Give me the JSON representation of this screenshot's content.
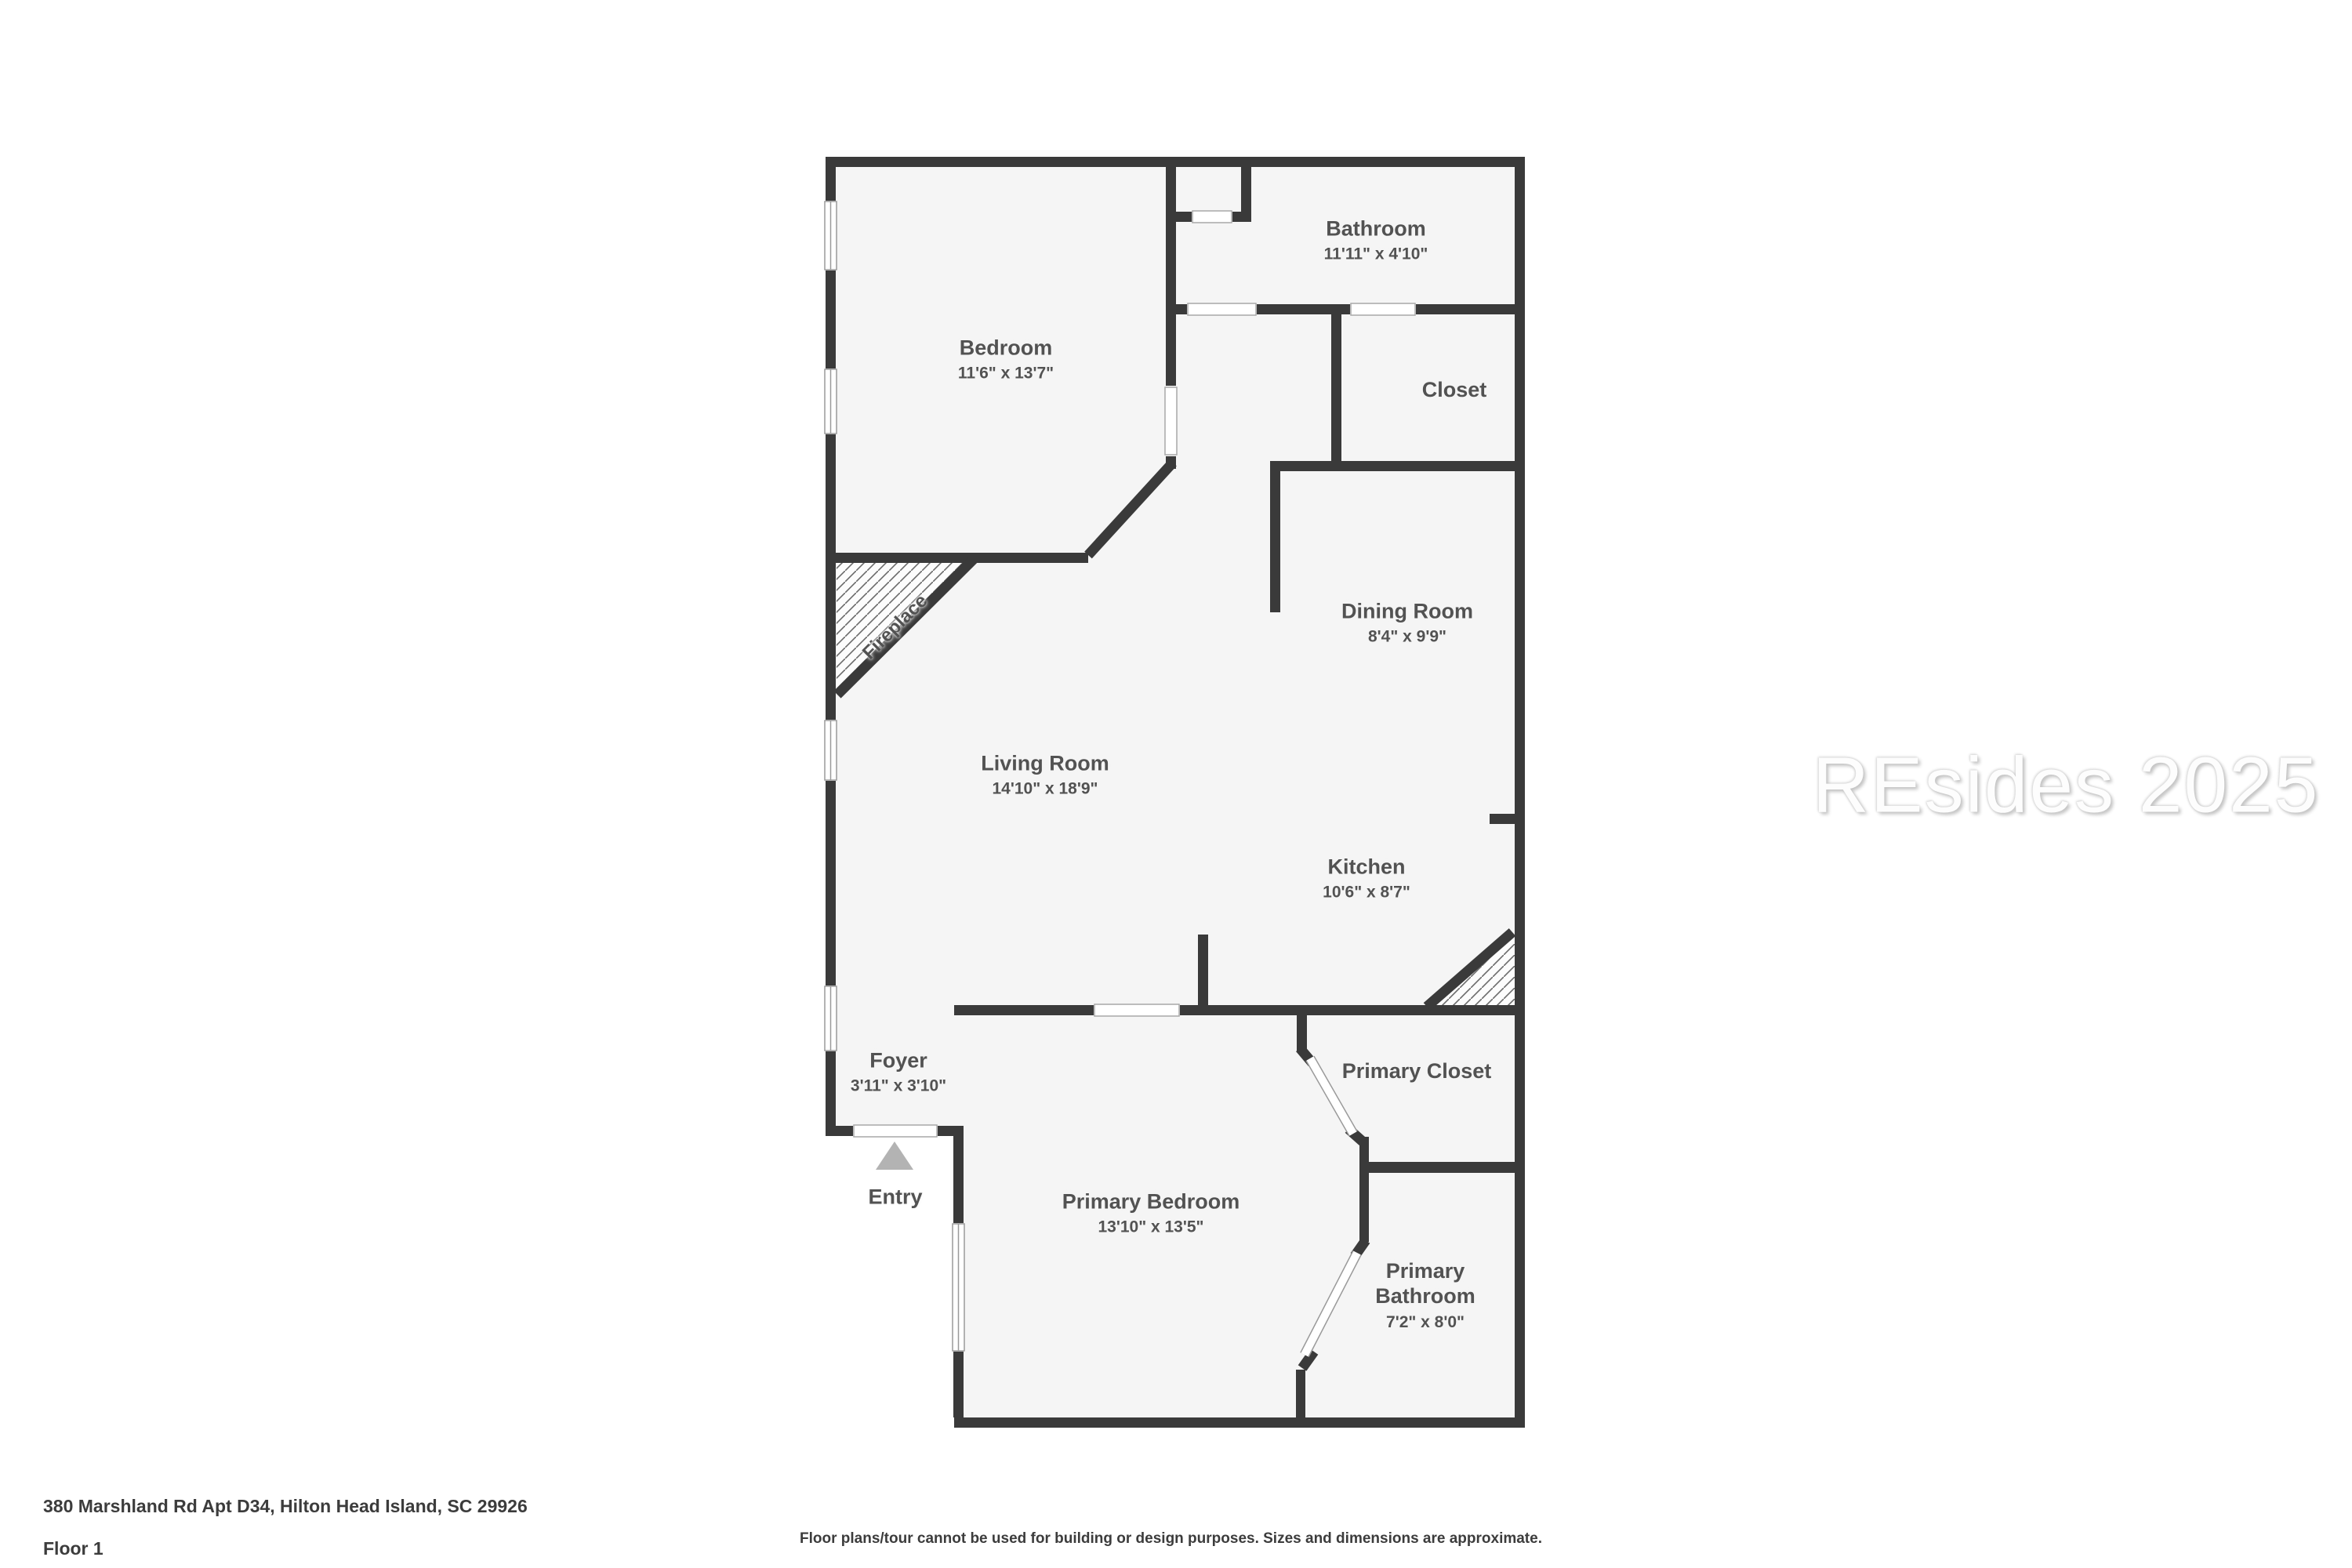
{
  "plan": {
    "rooms": {
      "bathroom": {
        "name": "Bathroom",
        "dims": "11'11\" x 4'10\""
      },
      "bedroom": {
        "name": "Bedroom",
        "dims": "11'6\" x 13'7\""
      },
      "closet": {
        "name": "Closet",
        "dims": ""
      },
      "dining_room": {
        "name": "Dining Room",
        "dims": "8'4\" x 9'9\""
      },
      "living_room": {
        "name": "Living Room",
        "dims": "14'10\" x 18'9\""
      },
      "kitchen": {
        "name": "Kitchen",
        "dims": "10'6\" x 8'7\""
      },
      "foyer": {
        "name": "Foyer",
        "dims": "3'11\" x 3'10\""
      },
      "primary_closet": {
        "name": "Primary Closet",
        "dims": ""
      },
      "primary_bedroom": {
        "name": "Primary Bedroom",
        "dims": "13'10\" x 13'5\""
      },
      "primary_bathroom": {
        "name": "Primary Bathroom",
        "dims": "7'2\" x 8'0\""
      }
    },
    "annotations": {
      "fireplace": "Fireplace",
      "entry": "Entry"
    },
    "icons": {
      "entry_arrow": "entry-arrow-icon"
    },
    "colors": {
      "wall": "#3a3a3a",
      "floor": "#f5f5f5",
      "entry_arrow": "#b3b3b3",
      "label_text": "#525252",
      "hatch_line": "#6a6a6a"
    }
  },
  "watermark": {
    "text": "REsides 2025"
  },
  "footer": {
    "address": "380 Marshland Rd Apt D34, Hilton Head Island, SC 29926",
    "floor_label": "Floor 1",
    "disclaimer": "Floor plans/tour cannot be used for building or design purposes. Sizes and dimensions are approximate."
  }
}
